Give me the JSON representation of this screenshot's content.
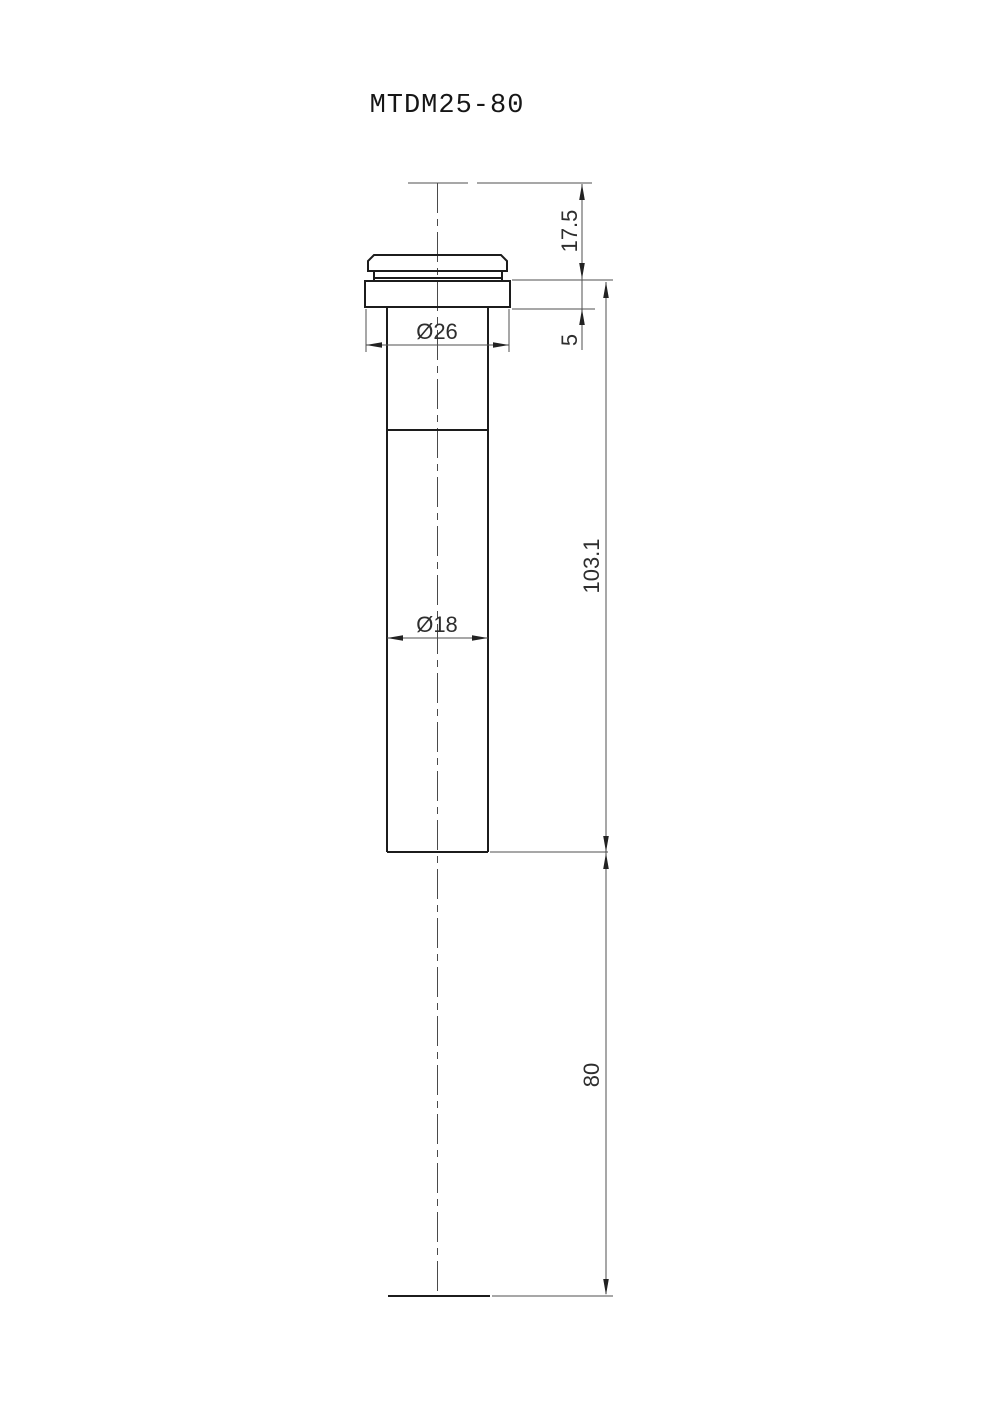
{
  "drawing": {
    "title": "MTDM25-80",
    "dimensions": {
      "top_to_flange": "17.5",
      "flange_thickness": "5",
      "flange_to_tip": "103.1",
      "protrusion": "80",
      "flange_diameter": "Ø26",
      "body_diameter": "Ø18"
    },
    "colors": {
      "object_line": "#1c1c1c",
      "thin_line": "#4f4f4f",
      "text": "#2e2e2e",
      "background": "#ffffff"
    }
  }
}
